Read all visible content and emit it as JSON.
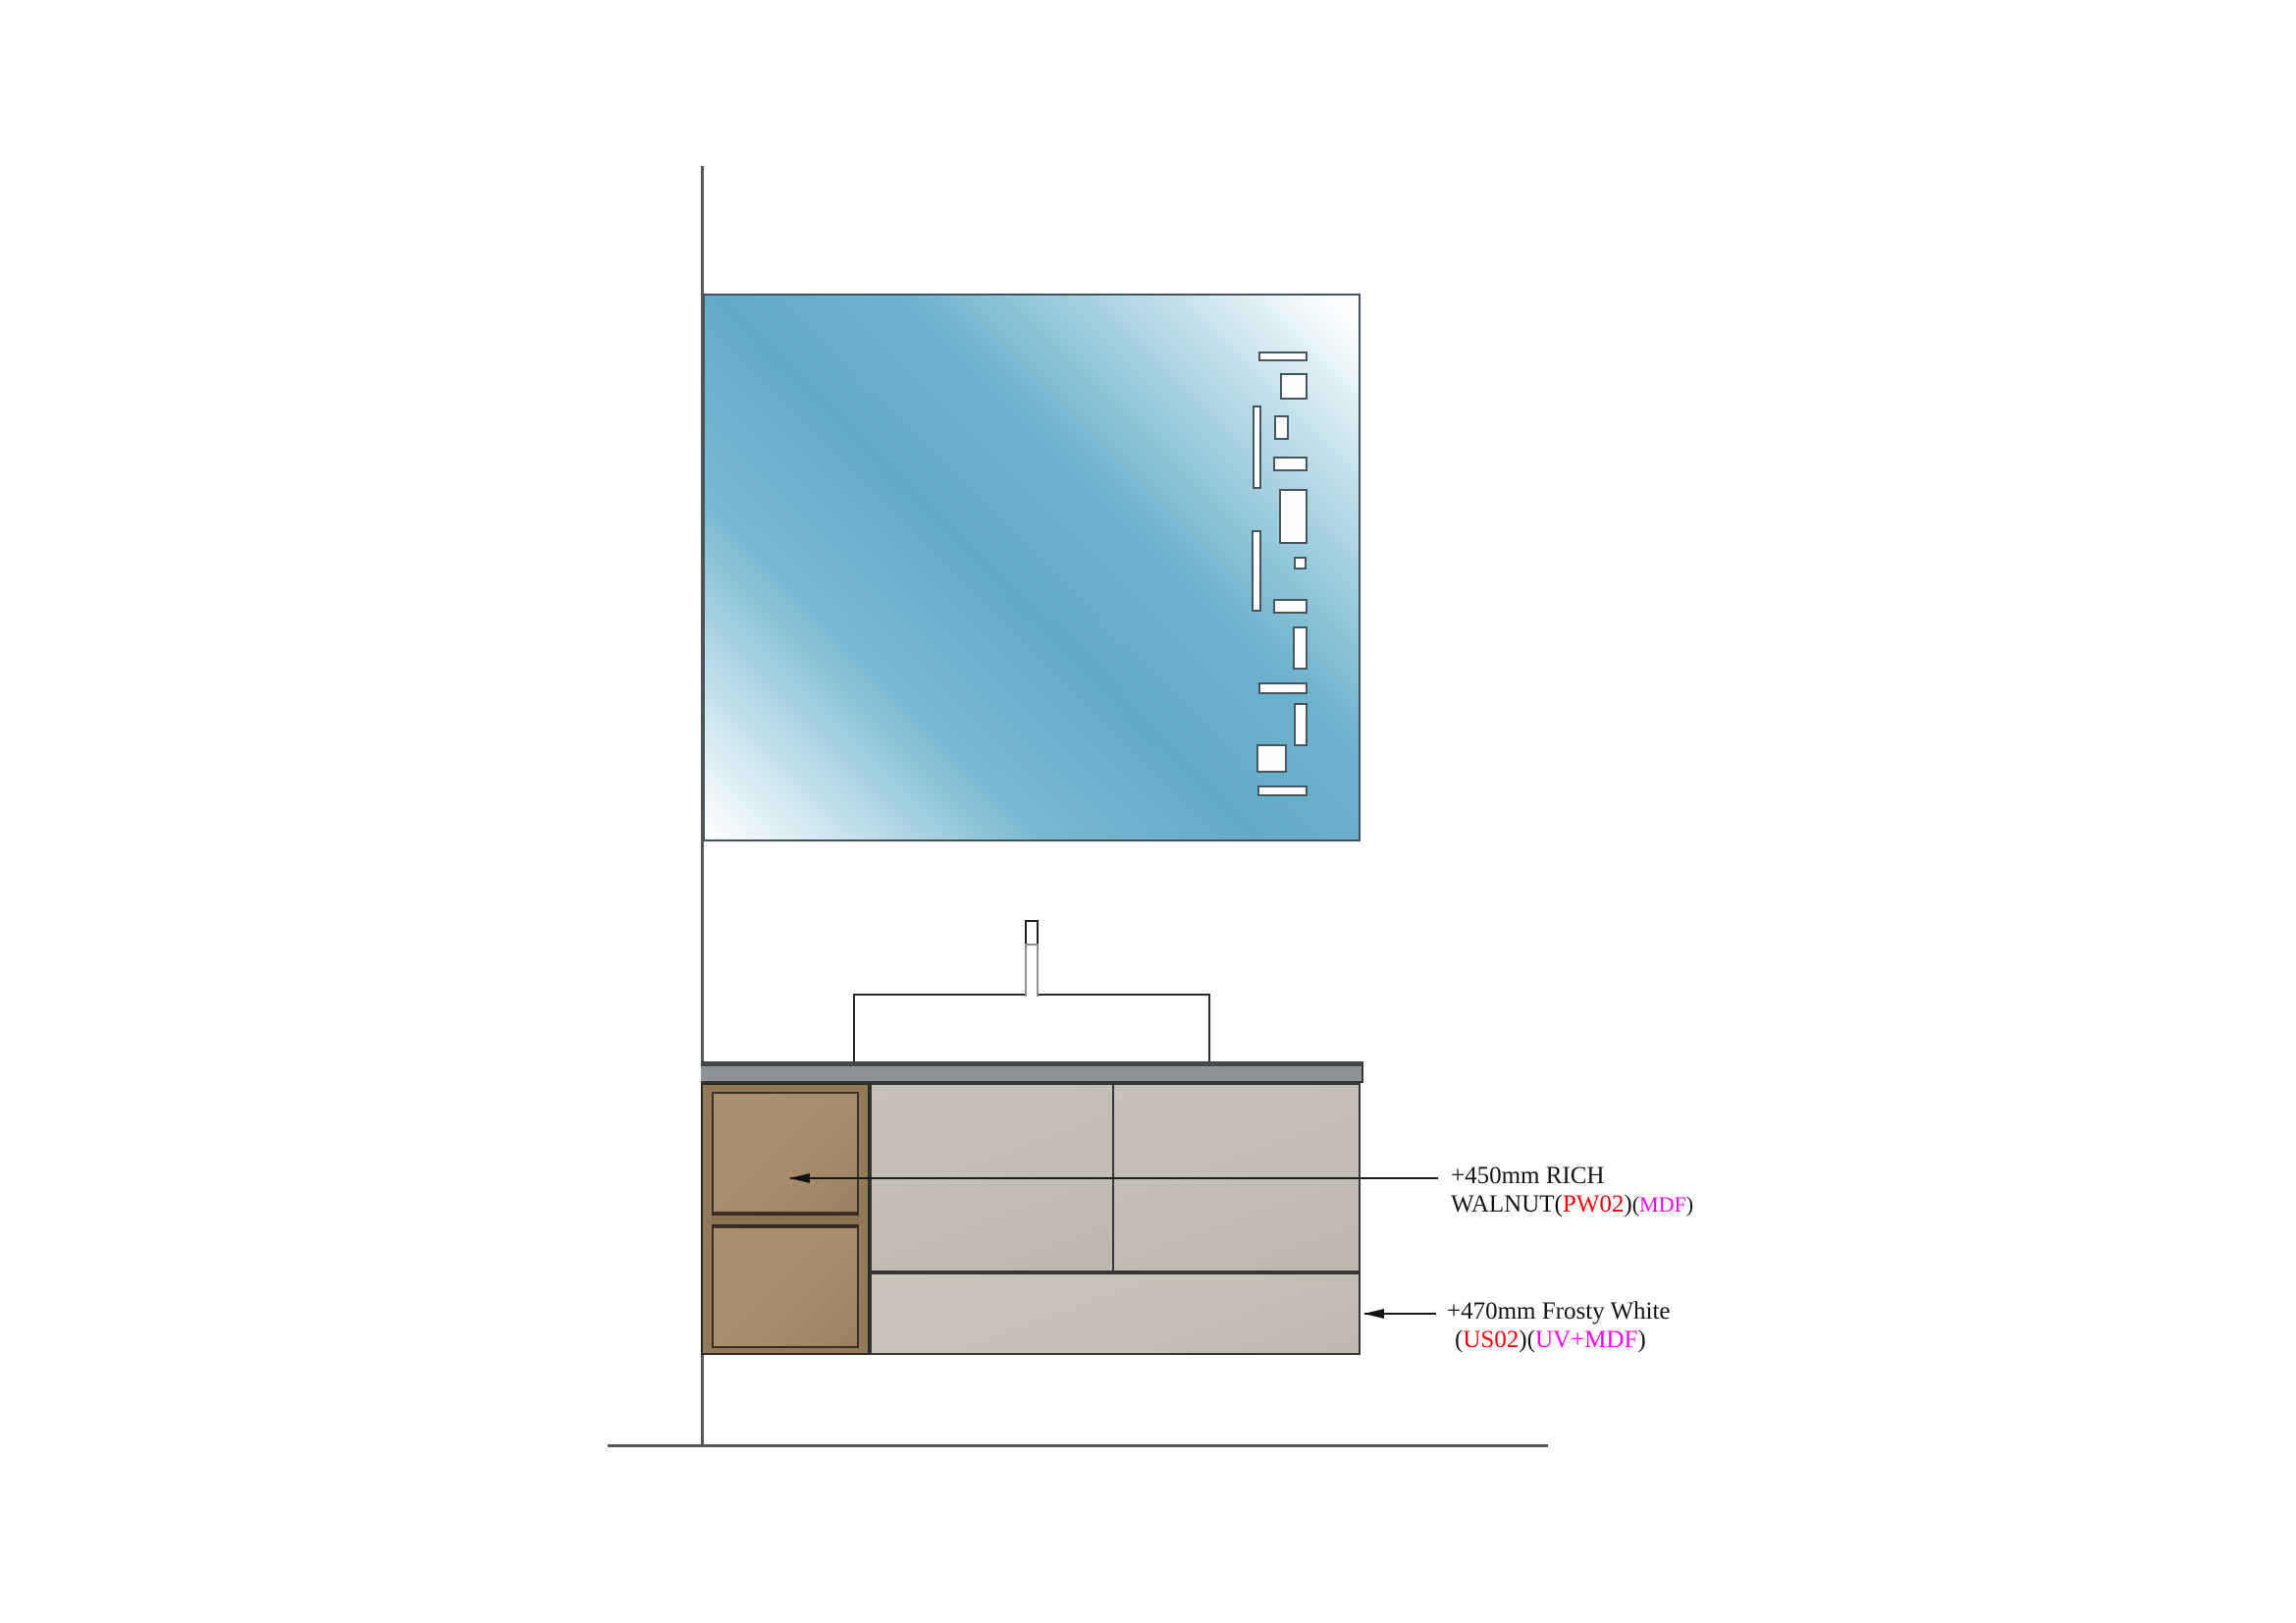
{
  "drawing": {
    "title": "bathroom vanity elevation",
    "elements": {
      "mirror": "mirror with cutout pattern",
      "sink": "vessel sink",
      "faucet": "deck faucet",
      "countertop": "countertop slab",
      "cabinet": "wall-hung vanity cabinet"
    },
    "annotations": [
      {
        "id": "walnut",
        "target": "upper wood drawer front",
        "lines": [
          [
            {
              "text": "+450mm RICH",
              "color": "black",
              "size": "normal"
            }
          ],
          [
            {
              "text": "WALNUT(",
              "color": "black",
              "size": "normal"
            },
            {
              "text": "PW02",
              "color": "red",
              "size": "normal"
            },
            {
              "text": ")",
              "color": "black",
              "size": "normal"
            },
            {
              "text": "(",
              "color": "black",
              "size": "small"
            },
            {
              "text": "MDF",
              "color": "magenta",
              "size": "small"
            },
            {
              "text": ")",
              "color": "black",
              "size": "small"
            }
          ]
        ]
      },
      {
        "id": "frosty",
        "target": "cabinet right side",
        "lines": [
          [
            {
              "text": "+470mm Frosty White",
              "color": "black",
              "size": "normal"
            }
          ],
          [
            {
              "text": "(",
              "color": "black",
              "size": "normal"
            },
            {
              "text": "US02",
              "color": "red",
              "size": "normal"
            },
            {
              "text": ")(",
              "color": "black",
              "size": "normal"
            },
            {
              "text": "UV+MDF",
              "color": "magenta",
              "size": "normal"
            },
            {
              "text": ")",
              "color": "black",
              "size": "normal"
            }
          ]
        ]
      }
    ],
    "colors": {
      "annotation_black": "#141414",
      "annotation_red": "#f50008",
      "annotation_magenta": "#fb02fb",
      "mirror_blue": "#62abc8",
      "countertop_gray": "#8e9297",
      "cabinet_gray": "#c2bcb2",
      "wood_frame": "#93795a",
      "wood_panel": "#a78d6b",
      "line_gray": "#565656"
    }
  }
}
